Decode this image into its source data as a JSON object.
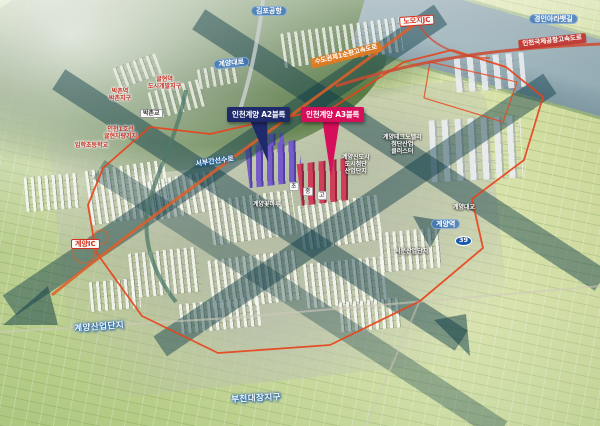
{
  "colors": {
    "callout_navy": "#1e2a6a",
    "callout_red": "#d60f5a",
    "district_boundary": "#e8431c",
    "expressway_orange": "#de5f28",
    "corridor_band_teal": "#0b3a46",
    "road_pill_blue": "#3e76bc"
  },
  "callouts": {
    "a2": "인천계양 A2블록",
    "a3": "인천계양 A3블록"
  },
  "map_labels": [
    {
      "id": "gimpo-airport",
      "type": "pill-blue",
      "text": "김포공항",
      "x": 251,
      "y": 6,
      "r": 0
    },
    {
      "id": "noojijc",
      "type": "pill-white-red",
      "text": "노오지JC",
      "x": 399,
      "y": 17,
      "r": -4
    },
    {
      "id": "ara-waterway",
      "type": "pill-blue",
      "text": "경인아라뱃길",
      "x": 529,
      "y": 14,
      "r": 0
    },
    {
      "id": "airport-expressway",
      "type": "banner-red",
      "text": "인천국제공항고속도로",
      "x": 518,
      "y": 40,
      "r": -6
    },
    {
      "id": "ring-expressway",
      "type": "banner-orange",
      "text": "수도권제1순환고속도로",
      "x": 310,
      "y": 59,
      "r": -14
    },
    {
      "id": "gyeyang-daero",
      "type": "pill-blue",
      "text": "계양대로",
      "x": 213,
      "y": 60,
      "r": -6
    },
    {
      "id": "gyulhyeon-district",
      "type": "text-red",
      "lines": [
        "귤현역",
        "도시개발지구"
      ],
      "x": 148,
      "y": 76,
      "r": 0
    },
    {
      "id": "bakchon-district",
      "type": "text-red",
      "lines": [
        "박촌역",
        "박촌지구"
      ],
      "x": 109,
      "y": 88,
      "r": 0
    },
    {
      "id": "gyulhyeon-depot",
      "type": "text-red",
      "lines": [
        "인천1호선",
        "귤현차량기지"
      ],
      "x": 104,
      "y": 126,
      "r": 0
    },
    {
      "id": "imhak-elementary",
      "type": "text-red",
      "text": "임학초등학교",
      "x": 75,
      "y": 142,
      "r": 0
    },
    {
      "id": "bakchon-bridge",
      "type": "pill-white",
      "text": "박촌교",
      "x": 140,
      "y": 109,
      "r": 0
    },
    {
      "id": "seobu-canal",
      "type": "text-blue-outline-sm",
      "text": "서부간선수로",
      "x": 195,
      "y": 160,
      "r": -8
    },
    {
      "id": "school-elem",
      "type": "school",
      "text": "초",
      "x": 289,
      "y": 182,
      "r": 0
    },
    {
      "id": "school-mid",
      "type": "school",
      "text": "중",
      "x": 303,
      "y": 187,
      "r": 0
    },
    {
      "id": "school-high",
      "type": "school",
      "text": "고",
      "x": 317,
      "y": 191,
      "r": 0
    },
    {
      "id": "flower-park",
      "type": "text-white",
      "text": "계양꽃마루",
      "x": 253,
      "y": 201,
      "r": 0
    },
    {
      "id": "hightech-complex",
      "type": "text-white",
      "lines": [
        "계양신도시",
        "도시첨단",
        "산업단지"
      ],
      "x": 342,
      "y": 154,
      "r": 0
    },
    {
      "id": "industry-cluster",
      "type": "text-white",
      "lines": [
        "계양테크노밸리",
        "첨단산업",
        "클러스터"
      ],
      "x": 383,
      "y": 134,
      "r": 0
    },
    {
      "id": "gyeyang-station",
      "type": "pill-blue",
      "text": "계양역",
      "x": 431,
      "y": 219,
      "r": 0
    },
    {
      "id": "gyeyang-bridge",
      "type": "text-white",
      "text": "계양대교",
      "x": 453,
      "y": 204,
      "r": 0
    },
    {
      "id": "route-39",
      "type": "shield",
      "text": "39",
      "x": 455,
      "y": 236,
      "r": 0
    },
    {
      "id": "seoun-industrial",
      "type": "text-white",
      "text": "서운산업단지",
      "x": 395,
      "y": 248,
      "r": 0
    },
    {
      "id": "gyeyang-ic",
      "type": "pill-white-red",
      "text": "계양IC",
      "x": 71,
      "y": 239,
      "r": 0
    },
    {
      "id": "gyeyang-industrial",
      "type": "text-blue-outline",
      "text": "계양산업단지",
      "x": 74,
      "y": 324,
      "r": -4
    },
    {
      "id": "bucheon-daejang",
      "type": "text-blue-outline",
      "text": "부천대장지구",
      "x": 231,
      "y": 395,
      "r": -3
    }
  ]
}
